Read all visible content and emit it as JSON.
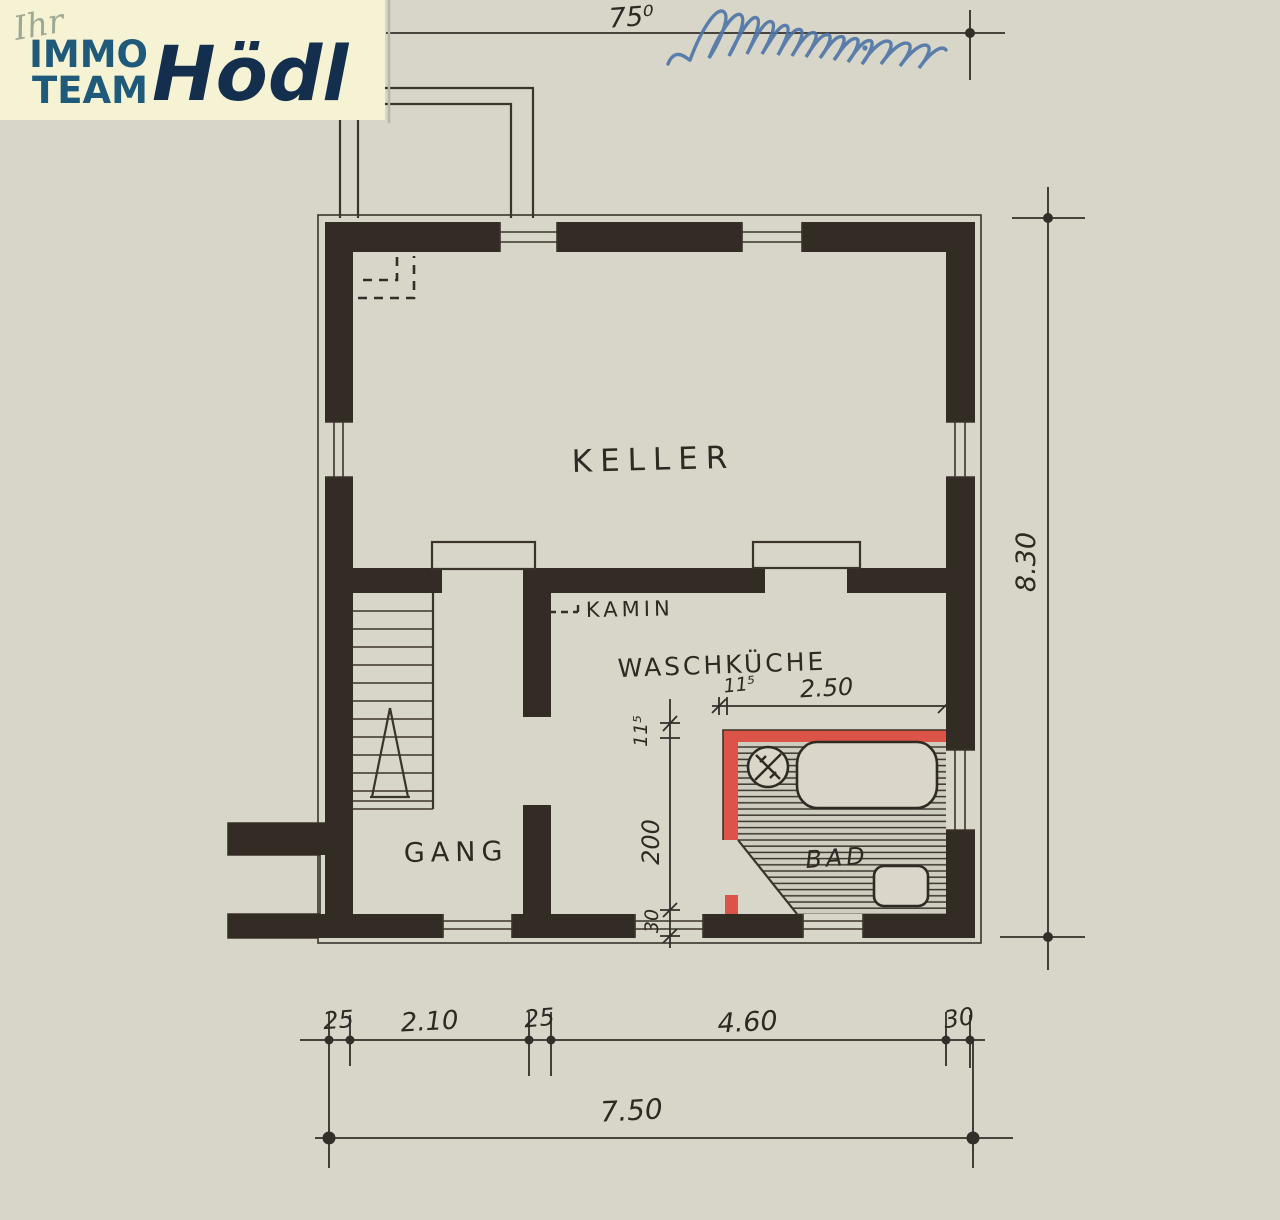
{
  "logo": {
    "prefix": "Ihr",
    "brand_line1": "IMMO",
    "brand_line2": "TEAM",
    "brand_name": "Hödl"
  },
  "rooms": {
    "keller": "KELLER",
    "waschkueche": "WASCHKÜCHE",
    "gang": "GANG",
    "bad": "BAD"
  },
  "annotations": {
    "kamin": "KAMIN"
  },
  "dimensions": {
    "top_total": "75⁰",
    "right_total": "8.30",
    "bath_wall_horizontal": "11⁵",
    "bath_width": "2.50",
    "bath_wall_vertical": "11⁵",
    "bath_depth": "200",
    "wall_bottom": "30",
    "bottom_chain": [
      "25",
      "2.10",
      "25",
      "4.60",
      "30"
    ],
    "bottom_total": "7.50"
  },
  "colors": {
    "paper": "#d8d5c9",
    "ink": "#322c25",
    "bath_highlight": "#dc5347",
    "handwriting_blue": "#4d74a6",
    "logo_background": "#f6f3d4",
    "logo_teal": "#1f5a7a",
    "logo_navy": "#132f4d"
  }
}
